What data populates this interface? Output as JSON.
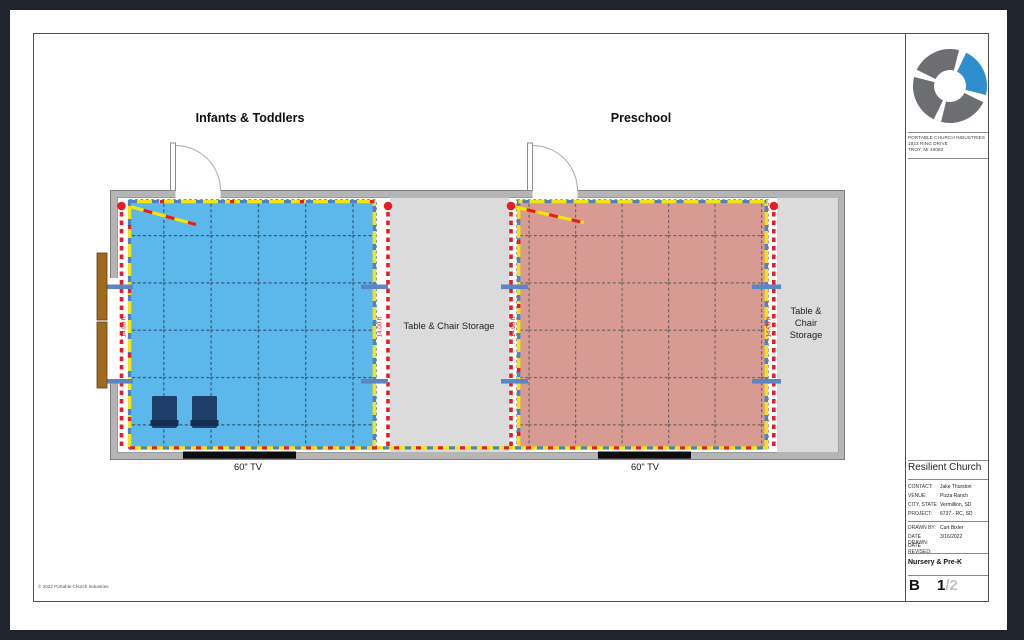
{
  "page": {
    "background_color": "#20242c",
    "sheet_color": "#ffffff",
    "copyright": "© 2022 Portable Church Industries"
  },
  "title_block": {
    "company_lines": [
      "PORTABLE CHURCH INDUSTRIES",
      "1923 RING DRIVE",
      "TROY, MI 48083"
    ],
    "client_name": "Resilient Church",
    "info_fields": [
      {
        "label": "CONTACT:",
        "value": "Jake Thurston"
      },
      {
        "label": "VENUE:",
        "value": "Pizza Ranch"
      },
      {
        "label": "CITY, STATE:",
        "value": "Vermillion, SD"
      },
      {
        "label": "PROJECT:",
        "value": "6737 - RC, SD"
      }
    ],
    "drawing_fields": [
      {
        "label": "DRAWN BY:",
        "value": "Curt Bixler"
      },
      {
        "label": "DATE DRAWN:",
        "value": "3/16/2022"
      },
      {
        "label": "DATE REVISED:",
        "value": ""
      }
    ],
    "sheet_title": "Nursery & Pre-K",
    "sheet_letter": "B",
    "sheet_number": "1",
    "sheet_total": "/2",
    "logo_colors": {
      "gray": "#6d6e71",
      "blue": "#2f8fce"
    }
  },
  "plan": {
    "room_left_title": "Infants & Toddlers",
    "room_right_title": "Preschool",
    "storage_center_label": "Table & Chair Storage",
    "storage_right_lines": [
      "Table &",
      "Chair",
      "Storage"
    ],
    "tv_label": "60\" TV",
    "drape_length_label": "14.00 ft",
    "colors": {
      "room_left_fill": "#5cb8ea",
      "room_right_fill": "#d79b94",
      "wall_gray": "#b5b5b5",
      "storage_fill": "#dbdbdb",
      "drape_yellow": "#f3e50c",
      "drape_red": "#e81c24",
      "support_blue": "#5b86c6",
      "chair_navy": "#1e3f69",
      "table_brown": "#9f6b1e"
    }
  }
}
